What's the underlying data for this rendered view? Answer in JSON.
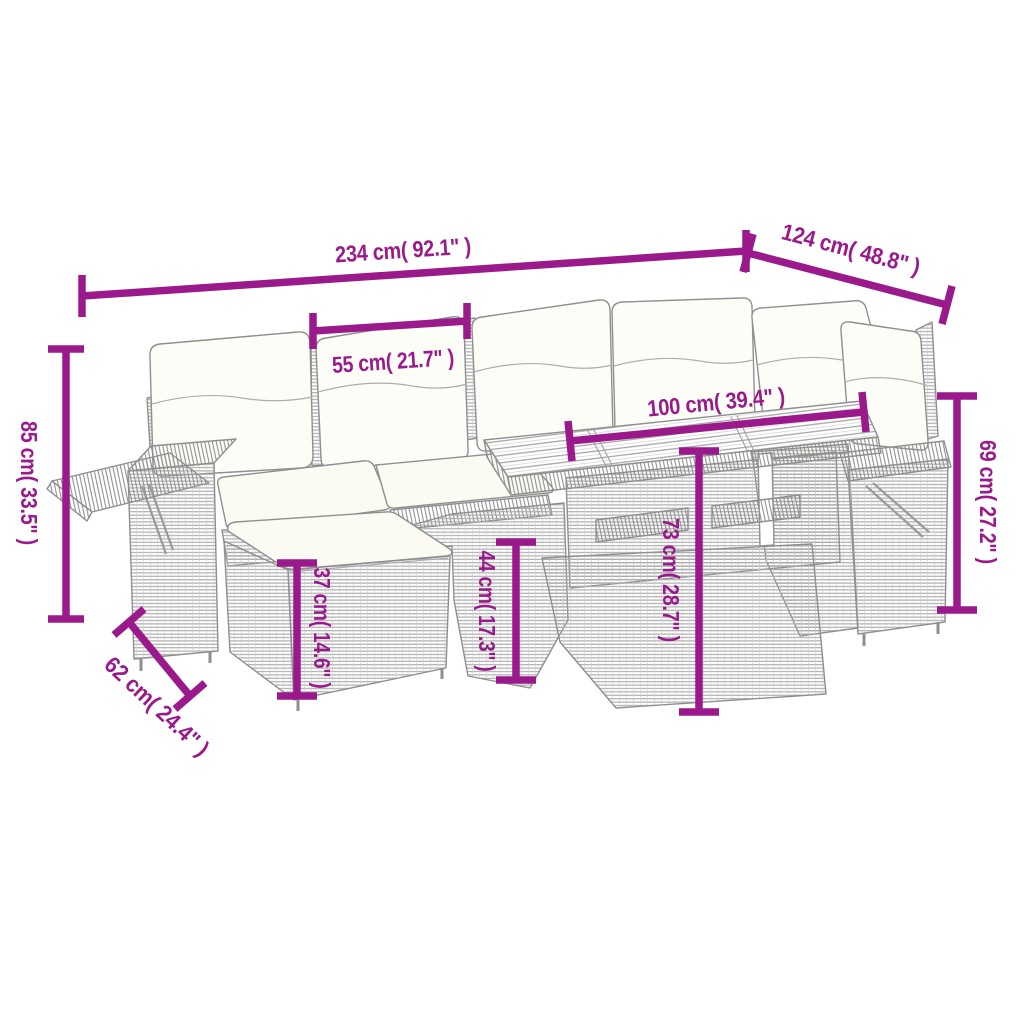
{
  "image": {
    "type": "product-dimension-diagram",
    "subject": "poly rattan garden lounge set with cushions, footstool and wood-top table",
    "background_color": "#ffffff",
    "dimension_color": "#9a1a8b",
    "furniture_line_color": "#8f8f8f",
    "cushion_color": "#fdfdf8"
  },
  "dimensions": {
    "total_width": {
      "label": "234 cm( 92.1\" )",
      "cm": 234,
      "in": 92.1
    },
    "total_depth": {
      "label": "124 cm( 48.8\" )",
      "cm": 124,
      "in": 48.8
    },
    "seat_width": {
      "label": "55 cm( 21.7\" )",
      "cm": 55,
      "in": 21.7
    },
    "total_height": {
      "label": "85 cm( 33.5\" )",
      "cm": 85,
      "in": 33.5
    },
    "table_width": {
      "label": "100 cm( 39.4\" )",
      "cm": 100,
      "in": 39.4
    },
    "armrest_height": {
      "label": "69 cm( 27.2\" )",
      "cm": 69,
      "in": 27.2
    },
    "table_height": {
      "label": "73 cm( 28.7\" )",
      "cm": 73,
      "in": 28.7
    },
    "seat_height": {
      "label": "44 cm( 17.3\" )",
      "cm": 44,
      "in": 17.3
    },
    "footstool_height": {
      "label": "37 cm( 14.6\" )",
      "cm": 37,
      "in": 14.6
    },
    "footstool_depth": {
      "label": "62 cm( 24.4\" )",
      "cm": 62,
      "in": 24.4
    }
  }
}
